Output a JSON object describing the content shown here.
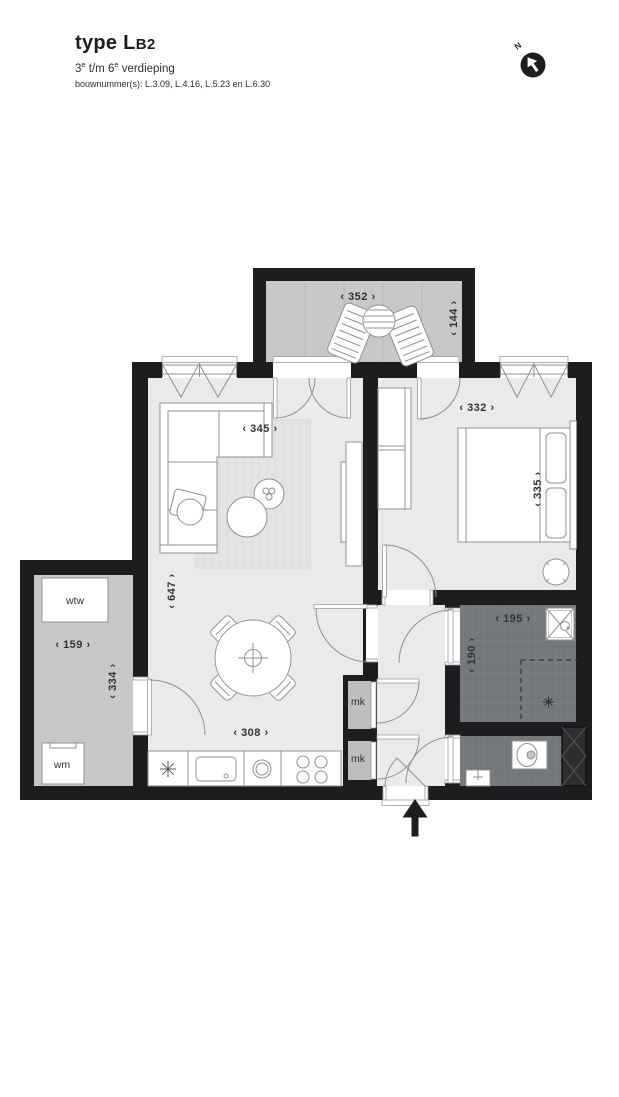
{
  "header": {
    "type_prefix": "type L",
    "type_suffix": "B2",
    "floors": {
      "pre": "3",
      "sup1": "e",
      "mid": " t/m 6",
      "sup2": "e",
      "post": " verdieping"
    },
    "bouwnummers": "bouwnummer(s): L.3.09, L.4.16, L.5.23 en L.6.30"
  },
  "north": {
    "label": "N"
  },
  "plan": {
    "dims": {
      "balcony_w": "‹ 352 ›",
      "balcony_d": "‹ 144 ›",
      "living_w": "‹ 345 ›",
      "bedroom_w": "‹ 332 ›",
      "bedroom_d": "‹ 335 ›",
      "living_d": "‹ 647 ›",
      "tech_w": "‹ 159 ›",
      "tech_d": "‹ 334 ›",
      "kitchen_w": "‹ 308 ›",
      "bath_w": "‹ 195 ›",
      "bath_d": "‹ 190 ›"
    },
    "labels": {
      "wtw": "wtw",
      "wm": "wm",
      "mk_upper": "mk",
      "mk_lower": "mk"
    },
    "colors": {
      "wall": "#1d1d1f",
      "floor_light": "#e9eaec",
      "floor_mid": "#c6c8ca",
      "floor_tile": "#74777b",
      "text": "#303234"
    }
  }
}
